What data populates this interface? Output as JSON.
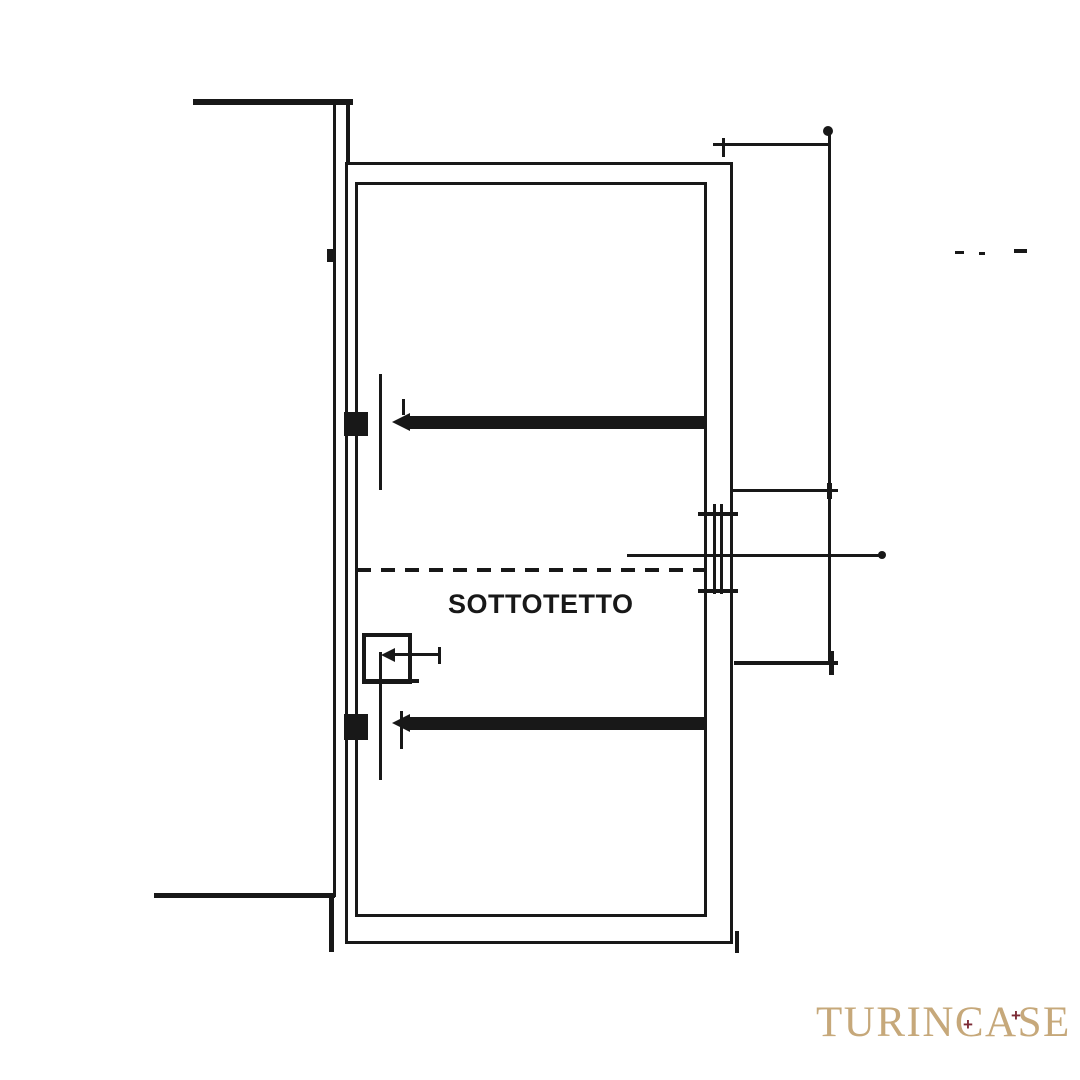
{
  "page": {
    "background": "#ffffff"
  },
  "plan": {
    "ink": "#181818",
    "room_label": "SOTTOTETTO",
    "shapes": [
      {
        "name": "left-site-boundary-line",
        "t": "v",
        "x": 333,
        "y": 103,
        "len": 794,
        "w": 3
      },
      {
        "name": "top-neighbor-wall-spur",
        "t": "h",
        "x": 193,
        "y": 99,
        "len": 160,
        "w": 6
      },
      {
        "name": "top-left-wall-connector",
        "t": "v",
        "x": 346,
        "y": 103,
        "len": 62,
        "w": 4
      },
      {
        "name": "bottom-neighbor-wall-spur",
        "t": "h",
        "x": 154,
        "y": 893,
        "len": 181,
        "w": 5
      },
      {
        "name": "bottom-left-wall-drop",
        "t": "v",
        "x": 329,
        "y": 894,
        "len": 58,
        "w": 5
      },
      {
        "name": "outer-wall-rect",
        "t": "r",
        "x": 345,
        "y": 162,
        "wd": 388,
        "ht": 782,
        "w": 3
      },
      {
        "name": "inner-wall-rect",
        "t": "r",
        "x": 355,
        "y": 182,
        "wd": 352,
        "ht": 735,
        "w": 3
      },
      {
        "name": "upper-beam",
        "t": "f",
        "x": 408,
        "y": 416,
        "wd": 299,
        "ht": 13
      },
      {
        "name": "upper-beam-arrowhead",
        "t": "tri",
        "x": 392,
        "y": 413,
        "wd": 18,
        "ht": 18
      },
      {
        "name": "upper-beam-tick",
        "t": "v",
        "x": 402,
        "y": 399,
        "len": 16,
        "w": 3
      },
      {
        "name": "lower-beam",
        "t": "f",
        "x": 408,
        "y": 717,
        "wd": 299,
        "ht": 13
      },
      {
        "name": "lower-beam-arrowhead",
        "t": "tri",
        "x": 392,
        "y": 714,
        "wd": 18,
        "ht": 18
      },
      {
        "name": "lower-beam-tick",
        "t": "v",
        "x": 400,
        "y": 711,
        "len": 38,
        "w": 3
      },
      {
        "name": "upper-section-line",
        "t": "v",
        "x": 379,
        "y": 374,
        "len": 116,
        "w": 3
      },
      {
        "name": "lower-section-line",
        "t": "v",
        "x": 379,
        "y": 652,
        "len": 128,
        "w": 3
      },
      {
        "name": "shaft-square",
        "t": "r",
        "x": 362,
        "y": 633,
        "wd": 50,
        "ht": 51,
        "w": 4
      },
      {
        "name": "shaft-square-base-extension",
        "t": "h",
        "x": 362,
        "y": 679,
        "len": 57,
        "w": 4
      },
      {
        "name": "shaft-arrow-line",
        "t": "h",
        "x": 387,
        "y": 653,
        "len": 54,
        "w": 3
      },
      {
        "name": "shaft-arrowhead",
        "t": "tri",
        "x": 381,
        "y": 648,
        "wd": 14,
        "ht": 14
      },
      {
        "name": "shaft-arrow-tick",
        "t": "v",
        "x": 438,
        "y": 647,
        "len": 17,
        "w": 3
      },
      {
        "name": "roof-dashed-line",
        "t": "dash",
        "x": 357,
        "y": 568,
        "len": 348,
        "w": 4
      },
      {
        "name": "dimension-leader-line",
        "t": "h",
        "x": 627,
        "y": 554,
        "len": 258,
        "w": 3
      },
      {
        "name": "dimension-leader-end-dot",
        "t": "dot",
        "x": 878,
        "y": 551,
        "r": 4
      },
      {
        "name": "window-top-tick",
        "t": "h",
        "x": 698,
        "y": 512,
        "len": 40,
        "w": 4
      },
      {
        "name": "window-bottom-tick",
        "t": "h",
        "x": 698,
        "y": 589,
        "len": 40,
        "w": 4
      },
      {
        "name": "window-pane-line-1",
        "t": "v",
        "x": 713,
        "y": 504,
        "len": 90,
        "w": 3
      },
      {
        "name": "window-pane-line-2",
        "t": "v",
        "x": 720,
        "y": 504,
        "len": 90,
        "w": 3
      },
      {
        "name": "right-dimension-line",
        "t": "v",
        "x": 828,
        "y": 131,
        "len": 534,
        "w": 3
      },
      {
        "name": "right-dimension-top-dot",
        "t": "dot",
        "x": 823,
        "y": 126,
        "r": 5
      },
      {
        "name": "top-dimension-line",
        "t": "h",
        "x": 713,
        "y": 143,
        "len": 118,
        "w": 3
      },
      {
        "name": "top-dimension-tick",
        "t": "v",
        "x": 722,
        "y": 138,
        "len": 19,
        "w": 3
      },
      {
        "name": "mid-dimension-line",
        "t": "h",
        "x": 733,
        "y": 489,
        "len": 105,
        "w": 3
      },
      {
        "name": "mid-dimension-tick",
        "t": "v",
        "x": 827,
        "y": 483,
        "len": 16,
        "w": 5
      },
      {
        "name": "bottom-dimension-line",
        "t": "h",
        "x": 734,
        "y": 661,
        "len": 104,
        "w": 4
      },
      {
        "name": "bottom-dimension-tick",
        "t": "v",
        "x": 829,
        "y": 651,
        "len": 24,
        "w": 5
      },
      {
        "name": "wall-hatch-upper",
        "t": "f",
        "x": 344,
        "y": 412,
        "wd": 24,
        "ht": 24
      },
      {
        "name": "wall-hatch-lower",
        "t": "f",
        "x": 344,
        "y": 714,
        "wd": 24,
        "ht": 26
      },
      {
        "name": "wall-hatch-small",
        "t": "f",
        "x": 327,
        "y": 249,
        "wd": 9,
        "ht": 13
      },
      {
        "name": "ink-speck-1",
        "t": "h",
        "x": 955,
        "y": 251,
        "len": 9,
        "w": 3
      },
      {
        "name": "ink-speck-2",
        "t": "h",
        "x": 979,
        "y": 252,
        "len": 6,
        "w": 3
      },
      {
        "name": "ink-speck-3",
        "t": "h",
        "x": 1014,
        "y": 249,
        "len": 13,
        "w": 4
      },
      {
        "name": "bottom-right-corner-tick",
        "t": "v",
        "x": 735,
        "y": 931,
        "len": 22,
        "w": 4
      }
    ]
  },
  "watermark": {
    "text": "TURINCASE",
    "color": "#c6a87a",
    "accent": "#7d2b36",
    "marks": [
      "+",
      "+"
    ]
  }
}
